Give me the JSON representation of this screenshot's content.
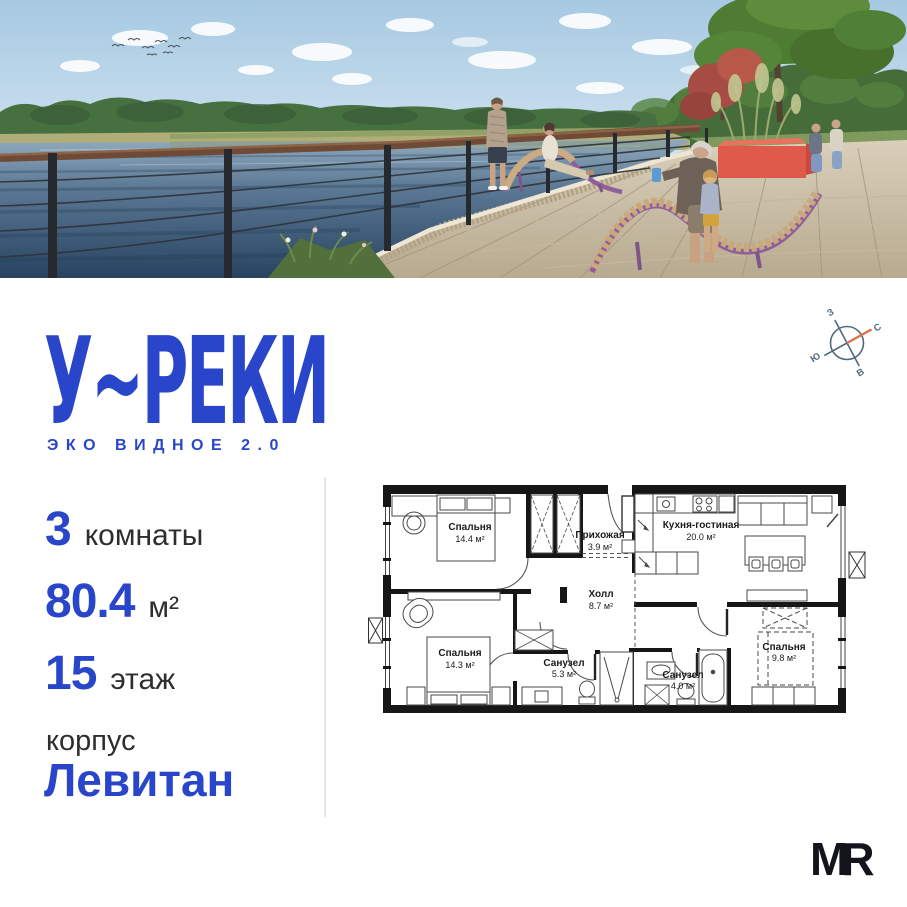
{
  "logo": {
    "title": "У~РЕКИ",
    "subtitle": "ЭКО ВИДНОЕ 2.0"
  },
  "stats": {
    "rooms_value": "3",
    "rooms_label": "комнаты",
    "area_value": "80.4",
    "area_label": "м²",
    "floor_value": "15",
    "floor_label": "этаж"
  },
  "building": {
    "label": "корпус",
    "name": "Левитан"
  },
  "compass": {
    "west": "З",
    "north": "С",
    "south": "Ю",
    "east": "В"
  },
  "floorplan": {
    "rooms": [
      {
        "name": "Спальня",
        "area": "14.4 м²"
      },
      {
        "name": "Прихожая",
        "area": "3.9 м²"
      },
      {
        "name": "Кухня-гостиная",
        "area": "20.0 м²"
      },
      {
        "name": "Холл",
        "area": "8.7 м²"
      },
      {
        "name": "Спальня",
        "area": "14.3 м²"
      },
      {
        "name": "Санузел",
        "area": "5.3 м²"
      },
      {
        "name": "Санузел",
        "area": "4.0 м²"
      },
      {
        "name": "Спальня",
        "area": "9.8 м²"
      }
    ]
  },
  "watermark": {
    "text": "MR"
  },
  "colors": {
    "brand_blue": "#2946CB",
    "text_dark": "#2e2e30",
    "compass_ring": "#50697b",
    "compass_needle": "#d8754f",
    "wall_black": "#161616",
    "planter_red": "#e05a4c",
    "lounger_purple": "#8f5f9b"
  }
}
